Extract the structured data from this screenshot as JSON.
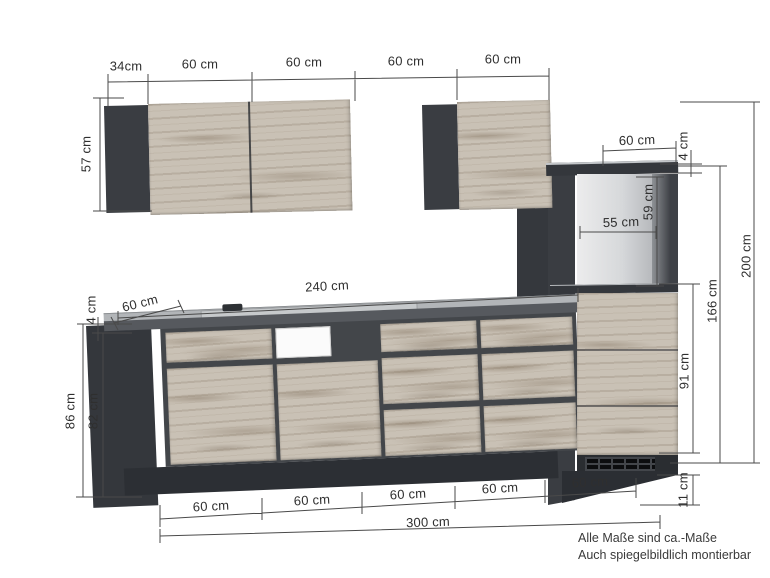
{
  "diagram_type": "kitchen-dimension-drawing",
  "dims": {
    "top_chain": [
      "34cm",
      "60 cm",
      "60 cm",
      "60 cm",
      "60 cm"
    ],
    "wall_cabinet_height": "57 cm",
    "worktop_length": "240 cm",
    "worktop_depth": "60 cm",
    "worktop_thickness": "4 cm",
    "base_total_height": "86 cm",
    "base_body_height": "82 cm",
    "tall_top_width": "60 cm",
    "tall_top_panel_thickness": "4 cm",
    "niche_height": "59 cm",
    "niche_width": "55 cm",
    "tall_body_height": "166 cm",
    "tall_front_height": "91 cm",
    "tall_plinth_height": "11 cm",
    "total_height": "200 cm",
    "bottom_chain": [
      "60 cm",
      "60 cm",
      "60 cm",
      "60 cm",
      "60 cm"
    ],
    "total_width": "300 cm"
  },
  "note": {
    "line1": "Alle Maße sind ca.-Maße",
    "line2": "Auch spiegelbildlich montierbar"
  },
  "colors": {
    "carcass": "#3e4146",
    "plinth": "#2c2f34",
    "wood": "#c9c1b5",
    "worktop_front": "#56595e",
    "worktop_top": "#b2b5b8",
    "niche_light": "#e8e9ea",
    "dimension_line": "#4a4a4a"
  }
}
